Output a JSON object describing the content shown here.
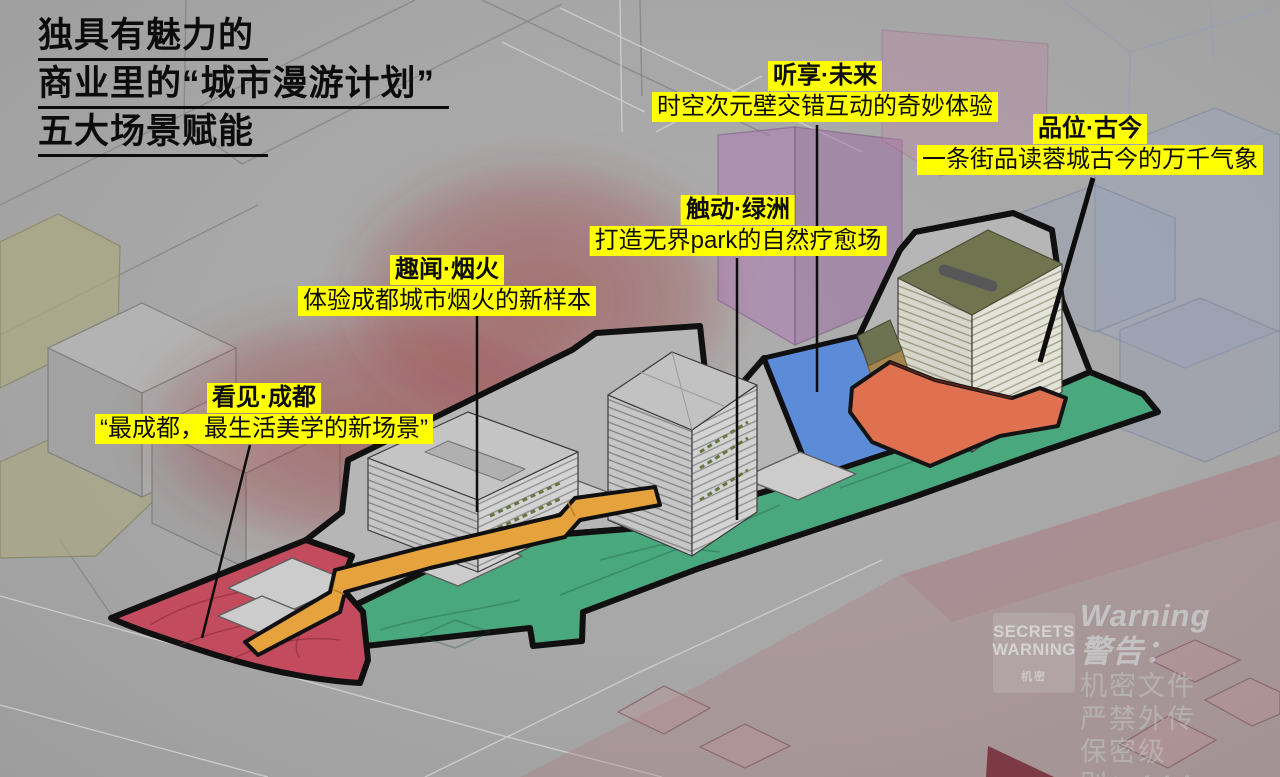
{
  "page": {
    "width": 1280,
    "height": 777
  },
  "title": {
    "line1": "独具有魅力的",
    "line2": "商业里的“城市漫游计划”",
    "line3": "五大场景赋能"
  },
  "scene_labels": [
    {
      "id": "kanjian-chengdu",
      "title": "看见·成都",
      "subtitle": "“最成都，最生活美学的新场景”"
    },
    {
      "id": "quwen-yanhuo",
      "title": "趣闻·烟火",
      "subtitle": "体验成都城市烟火的新样本"
    },
    {
      "id": "chudong-lvzhou",
      "title": "触动·绿洲",
      "subtitle": "打造无界park的自然疗愈场"
    },
    {
      "id": "tingxiang-weilai",
      "title": "听享·未来",
      "subtitle": "时空次元壁交错互动的奇妙体验"
    },
    {
      "id": "pinwei-gujin",
      "title": "品位·古今",
      "subtitle": "一条街品读蓉城古今的万千气象"
    }
  ],
  "watermark": {
    "stamp_line1": "SECRETS",
    "stamp_line2": "WARNING",
    "stamp_line3": "机密",
    "heading": "Warning警告：",
    "line2": "机密文件 严禁外传",
    "line3": "保密级别：AAA"
  },
  "colors": {
    "highlight_yellow": "#ffff00",
    "zone_red": "#c24b5e",
    "zone_green": "#4aa87f",
    "zone_blue": "#5c8cd8",
    "walkway_orange": "#e6a33d",
    "ribbon_salmon": "#df7050",
    "tower_roof_olive": "#70744f",
    "site_outline": "#101010",
    "background_gray": "#a7a7a7"
  }
}
